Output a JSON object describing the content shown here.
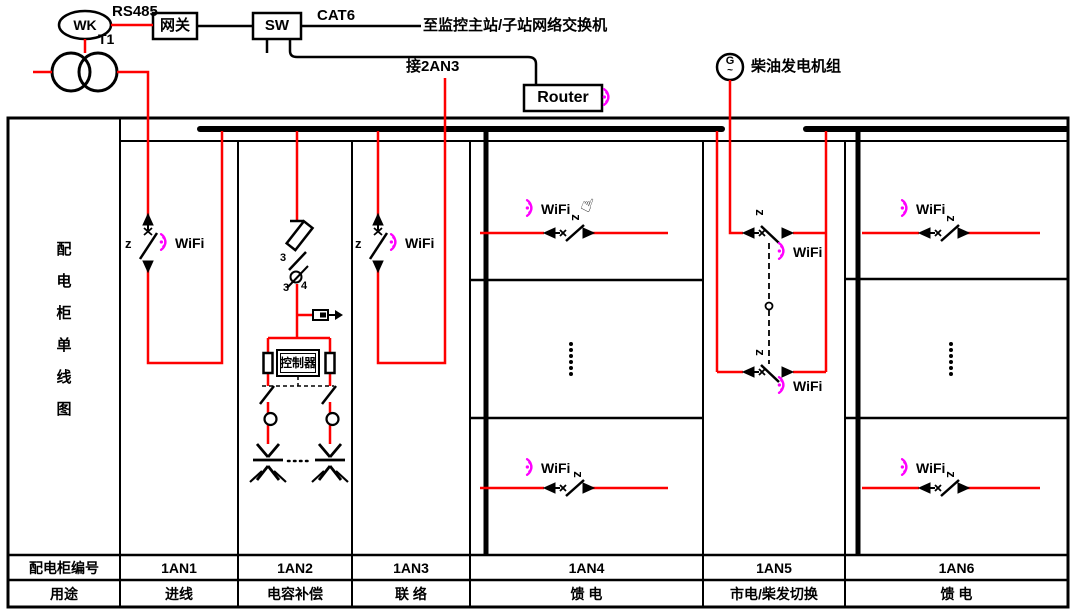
{
  "diagram_title": {
    "text": "配电柜单线图",
    "chars": [
      "配",
      "电",
      "柜",
      "单",
      "线",
      "图"
    ]
  },
  "network": {
    "wk": "WK",
    "rs485": "RS485",
    "gateway": "网关",
    "switch": "SW",
    "cat6": "CAT6",
    "to_monitor": "至监控主站/子站网络交换机",
    "to_2an3": "接2AN3",
    "router": "Router",
    "transformer": "T1"
  },
  "generator": {
    "symbol": "G",
    "wave": "~",
    "label": "柴油发电机组"
  },
  "labels": {
    "wifi": "WiFi",
    "z": "z",
    "controller": "控制器",
    "n3": "3",
    "n4": "4",
    "hand_icon": "☝"
  },
  "table": {
    "row1_header": "配电柜编号",
    "row2_header": "用途",
    "cabinets": [
      {
        "id": "1AN1",
        "use": "进线"
      },
      {
        "id": "1AN2",
        "use": "电容补偿"
      },
      {
        "id": "1AN3",
        "use": "联 络"
      },
      {
        "id": "1AN4",
        "use": "馈 电"
      },
      {
        "id": "1AN5",
        "use": "市电/柴发切换"
      },
      {
        "id": "1AN6",
        "use": "馈 电"
      }
    ]
  },
  "colors": {
    "circuit_red": "#fe0000",
    "wifi_magenta": "#ff00ff",
    "line_black": "#000000"
  }
}
